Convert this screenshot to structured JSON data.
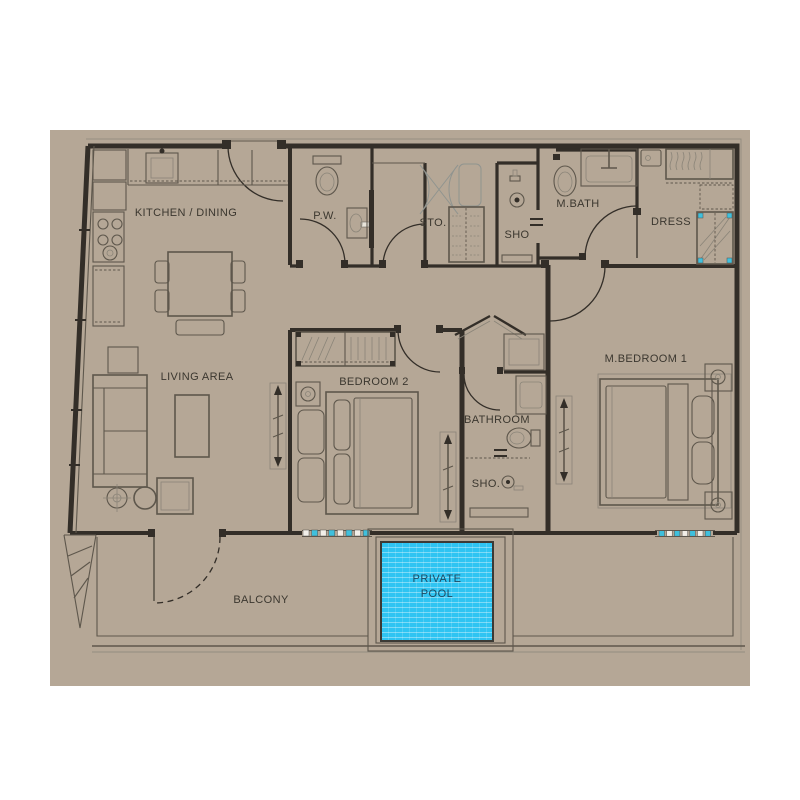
{
  "colors": {
    "page_bg": "#ffffff",
    "sheet": "#b5a796",
    "wall": "#332e28",
    "line": "#5e574c",
    "line_light": "#8a8478",
    "graphic_gray": "#90948f",
    "pool_fill": "#2fc4f2",
    "pool_text": "#1c4a63",
    "teal_accent": "#3fc0dd",
    "label": "#3b372f"
  },
  "labels": {
    "kitchen_dining": "KITCHEN / DINING",
    "powder_room": "P.W.",
    "storage": "STO.",
    "shower_top": "SHO",
    "master_bath": "M.BATH",
    "dressing": "DRESS",
    "living_area": "LIVING AREA",
    "bedroom2": "BEDROOM 2",
    "bathroom": "BATHROOM",
    "shower_bottom": "SHO.",
    "master_bedroom": "M.BEDROOM 1",
    "balcony": "BALCONY",
    "pool_line1": "PRIVATE",
    "pool_line2": "POOL"
  }
}
